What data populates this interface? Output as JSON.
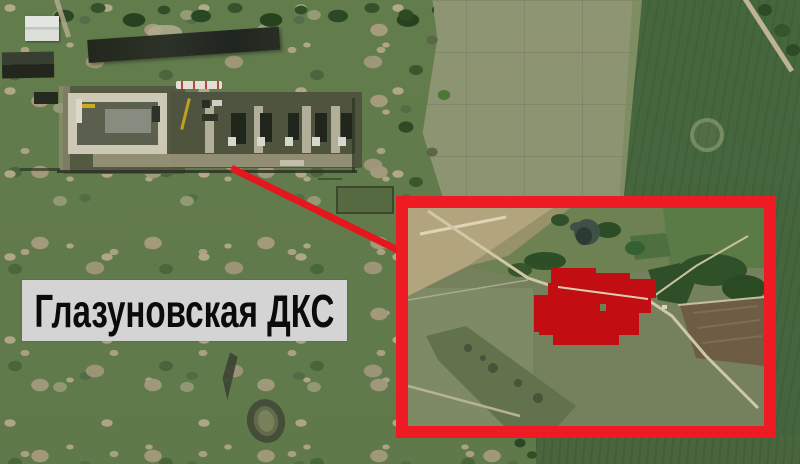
{
  "annotation": {
    "facility_label": "Глазуновская ДКС"
  },
  "colors": {
    "accent_red": "#ee1b24",
    "callout_line_red": "#e5161e",
    "highlight_mask_red": "#c20d13",
    "label_bg": "#d4d4d4",
    "label_text": "#0b0b0b"
  }
}
